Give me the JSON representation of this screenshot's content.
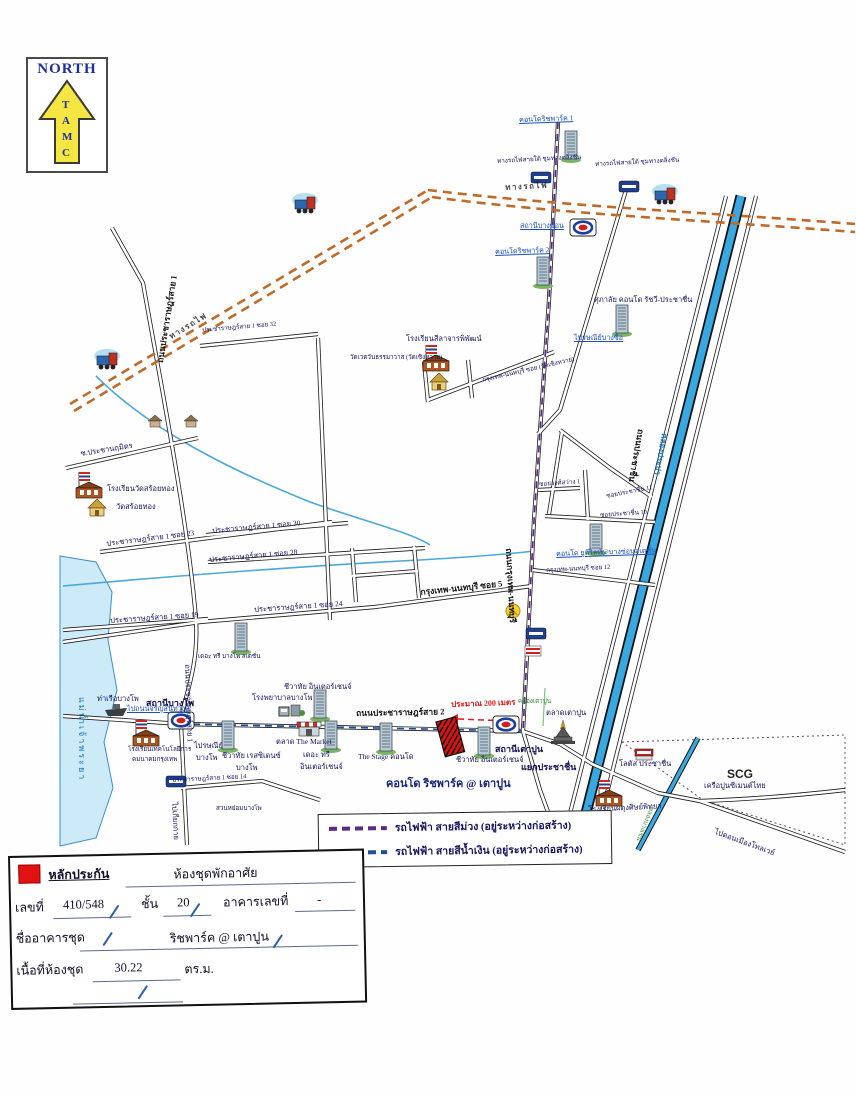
{
  "north": {
    "title": "NORTH",
    "letters": [
      "T",
      "A",
      "M",
      "C"
    ]
  },
  "legend": {
    "items": [
      {
        "label": "รถไฟฟ้า สายสีม่วง (อยู่ระหว่างก่อสร้าง)",
        "color": "#5b2a86"
      },
      {
        "label": "รถไฟฟ้า สายสีน้ำเงิน (อยู่ระหว่างก่อสร้าง)",
        "color": "#1c4f9c"
      }
    ]
  },
  "form": {
    "guarantee_label": "หลักประกัน",
    "type_value": "ห้องชุดพักอาศัย",
    "no_label": "เลขที่",
    "no_value": "410/548",
    "floor_label": "ชั้น",
    "floor_value": "20",
    "building_no_label": "อาคารเลขที่",
    "building_no_value": "-",
    "building_name_label": "ชื่ออาคารชุด",
    "building_name_value": "ริชพาร์ค @ เตาปูน",
    "area_label": "เนื้อที่ห้องชุด",
    "area_value": "30.22",
    "area_unit": "ตร.ม."
  },
  "colors": {
    "mrt_purple": "#5b2a86",
    "mrt_blue": "#1c4f9c",
    "railway": "#c06a28",
    "canal": "#39a7e0",
    "river_fill": "#cdeaf8",
    "subject_red": "#e11212"
  },
  "map": {
    "labels": [
      {
        "name": "condo-richpark1-label",
        "text": "คอนโดริชพาร์ค 1",
        "x": 519,
        "y": 117,
        "cls": "blue",
        "rot": -2
      },
      {
        "name": "railway-caption-1",
        "text": "ทางรถไฟสายใต้ ชุมทางตลิ่งชัน",
        "x": 497,
        "y": 159,
        "cls": "sm6",
        "rot": -3
      },
      {
        "name": "railway-caption-2",
        "text": "ทางรถไฟสายใต้ ชุมทางตลิ่งชัน",
        "x": 595,
        "y": 162,
        "cls": "sm6",
        "rot": -3
      },
      {
        "name": "station-bangson-label",
        "text": "สถานีบางซ่อน",
        "x": 520,
        "y": 223,
        "cls": "blue"
      },
      {
        "name": "condo-richpark2-label",
        "text": "คอนโดริชพาร์ค 2",
        "x": 495,
        "y": 249,
        "cls": "blue",
        "rot": -2
      },
      {
        "name": "condo-supalai-label",
        "text": "ศุภาลัย คอนโด รัชวี-ประชาชื่น",
        "x": 594,
        "y": 296,
        "cls": ""
      },
      {
        "name": "post-bangsue-label",
        "text": "ไปรษณีย์บางซื่อ",
        "x": 574,
        "y": 335,
        "cls": "blue"
      },
      {
        "name": "road-pracharat1-label-top",
        "text": "ถนนประชาราษฎร์สาย 1",
        "x": 156,
        "y": 362,
        "cls": "rd",
        "rot": -81
      },
      {
        "name": "soi32-label",
        "text": "ประชาราษฎร์สาย 1 ซอย 32",
        "x": 202,
        "y": 328,
        "cls": "sm6",
        "rot": -5
      },
      {
        "name": "school-silacharn-label",
        "text": "โรงเรียนสีลาจารพิพัฒน์",
        "x": 406,
        "y": 335,
        "cls": ""
      },
      {
        "name": "wat-soenghwai-label",
        "text": "วัดเวตวันธรรมาวาส (วัดเซิงหวาย)",
        "x": 350,
        "y": 355,
        "cls": "sm6"
      },
      {
        "name": "soi-wat-soenghwai-label",
        "text": "กรุงเทพ-นนทบุรี ซอย (วัดเซิงหวาย)",
        "x": 482,
        "y": 378,
        "cls": "sm6",
        "rot": -13
      },
      {
        "name": "soi-prachanarumit-label",
        "text": "ซ.ประชานฤมิตร",
        "x": 80,
        "y": 450,
        "cls": "",
        "rot": -9
      },
      {
        "name": "school-watsoithong-label",
        "text": "โรงเรียนวัดสร้อยทอง",
        "x": 107,
        "y": 485,
        "cls": ""
      },
      {
        "name": "wat-soithong-label",
        "text": "วัดสร้อยทอง",
        "x": 116,
        "y": 503,
        "cls": ""
      },
      {
        "name": "soi23-label",
        "text": "ประชาราษฎร์สาย 1 ซอย 23",
        "x": 106,
        "y": 540,
        "cls": "",
        "rot": -7
      },
      {
        "name": "soi30-label",
        "text": "ประชาราษฎร์สาย 1 ซอย 30",
        "x": 212,
        "y": 527,
        "cls": "",
        "rot": -5
      },
      {
        "name": "soi28-label",
        "text": "ประชาราษฎร์สาย 1 ซอย 28",
        "x": 209,
        "y": 556,
        "cls": "",
        "rot": -5
      },
      {
        "name": "soi24-label",
        "text": "ประชาราษฎร์สาย 1 ซอย 24",
        "x": 254,
        "y": 606,
        "cls": "",
        "rot": -4
      },
      {
        "name": "soi19-label",
        "text": "ประชาราษฎร์สาย 1 ซอย 19",
        "x": 110,
        "y": 617,
        "cls": "",
        "rot": -4
      },
      {
        "name": "krungthep-non-soi5-label",
        "text": "กรุงเทพ-นนทบุรี ซอย 5",
        "x": 420,
        "y": 588,
        "cls": "rd",
        "rot": -6
      },
      {
        "name": "soi-wongsawang1-label",
        "text": "ซอยวงศ์สว่าง 1",
        "x": 539,
        "y": 482,
        "cls": "sm6",
        "rot": -4
      },
      {
        "name": "soi-prachachuen11-label",
        "text": "ซอยประชาชื่น 11",
        "x": 606,
        "y": 494,
        "cls": "sm6",
        "rot": -11
      },
      {
        "name": "soi-prachachuen10-label",
        "text": "ซอยประชาชื่น 10",
        "x": 600,
        "y": 513,
        "cls": "sm6",
        "rot": -4
      },
      {
        "name": "condo-udelight-label",
        "text": "คอนโด ยูดีไลท์@บางซ่อนสเตชั่น",
        "x": 556,
        "y": 551,
        "cls": "blue",
        "rot": -2
      },
      {
        "name": "krungthep-non-soi12-label",
        "text": "กรุงเทพ-นนทบุรี ซอย 12",
        "x": 546,
        "y": 568,
        "cls": "sm6",
        "rot": -3
      },
      {
        "name": "road-krungthep-non-label",
        "text": "ถนนกรุงเทพ-นนทบุรี",
        "x": 513,
        "y": 548,
        "cls": "rd",
        "rot": 87
      },
      {
        "name": "road-prachachuen-label",
        "text": "ถนนประชาชื่น",
        "x": 645,
        "y": 430,
        "cls": "rd",
        "rot": 100
      },
      {
        "name": "canal-prapa-label",
        "text": "คลองประปา",
        "x": 668,
        "y": 434,
        "cls": "canal",
        "rot": 100
      },
      {
        "name": "talat-taopoon-label",
        "text": "ตลาดเตาปูน",
        "x": 546,
        "y": 709,
        "cls": ""
      },
      {
        "name": "canal-taopoon-label",
        "text": "คลองเตาปูน",
        "x": 518,
        "y": 699,
        "cls": "green"
      },
      {
        "name": "station-taopoon-label",
        "text": "สถานีเตาปูน",
        "x": 495,
        "y": 745,
        "cls": "st"
      },
      {
        "name": "yaek-prachachuen-label",
        "text": "แยกประชาชื่น",
        "x": 521,
        "y": 763,
        "cls": "st"
      },
      {
        "name": "lotus-label",
        "text": "โลตัส ประชาชื่น",
        "x": 619,
        "y": 760,
        "cls": ""
      },
      {
        "name": "scg-label",
        "text": "SCG",
        "x": 727,
        "y": 768,
        "cls": "scg"
      },
      {
        "name": "scg-sub-label",
        "text": "เครือปูนซีเมนต์ไทย",
        "x": 704,
        "y": 782,
        "cls": ""
      },
      {
        "name": "school-phadung-label",
        "text": "โรงเรียนผดุงศิษย์พิทยา",
        "x": 588,
        "y": 806,
        "cls": "",
        "rot": -3
      },
      {
        "name": "to-tollway-label",
        "text": "ไปดอนเมืองโทลเวย์",
        "x": 716,
        "y": 828,
        "cls": "",
        "rot": 20
      },
      {
        "name": "canal-bangkhen-label",
        "text": "คลองบางเขน",
        "x": 654,
        "y": 808,
        "cls": "green",
        "rot": 112
      },
      {
        "name": "distance-label",
        "text": "ประมาณ 200 เมตร",
        "x": 451,
        "y": 701,
        "cls": "red",
        "rot": -2
      },
      {
        "name": "condo-richpark-taopoon-label",
        "text": "คอนโด ริชพาร์ค @ เตาปูน",
        "x": 386,
        "y": 778,
        "cls": "big"
      },
      {
        "name": "chewathai-interchange1-label",
        "text": "ชีวาทัย อินเตอร์เชนจ์",
        "x": 284,
        "y": 683,
        "cls": ""
      },
      {
        "name": "hospital-bangpho-label",
        "text": "โรงพยาบาลบางโพ",
        "x": 252,
        "y": 694,
        "cls": ""
      },
      {
        "name": "road-pracharat2-label",
        "text": "ถนนประชาราษฎร์สาย 2",
        "x": 356,
        "y": 709,
        "cls": "rd",
        "rot": -1
      },
      {
        "name": "chewathai-interchange2-label",
        "text": "ชีวาทัย อินเตอร์เชนจ์",
        "x": 456,
        "y": 756,
        "cls": ""
      },
      {
        "name": "the-stage-label",
        "text": "The Stage คอนโด",
        "x": 358,
        "y": 753,
        "cls": ""
      },
      {
        "name": "the-tree-interchange-label1",
        "text": "เดอะ ทรี",
        "x": 303,
        "y": 751,
        "cls": ""
      },
      {
        "name": "the-tree-interchange-label2",
        "text": "อินเตอร์เชนจ์",
        "x": 300,
        "y": 763,
        "cls": ""
      },
      {
        "name": "the-market-label",
        "text": "ตลาด The Market",
        "x": 276,
        "y": 738,
        "cls": ""
      },
      {
        "name": "chewathai-residence-label1",
        "text": "ชีวาทัย เรสซิเดนซ์",
        "x": 222,
        "y": 752,
        "cls": ""
      },
      {
        "name": "chewathai-residence-label2",
        "text": "บางโพ",
        "x": 236,
        "y": 764,
        "cls": ""
      },
      {
        "name": "post-bangpho-label1",
        "text": "ไปรษณีย์",
        "x": 194,
        "y": 742,
        "cls": ""
      },
      {
        "name": "post-bangpho-label2",
        "text": "บางโพ",
        "x": 196,
        "y": 754,
        "cls": ""
      },
      {
        "name": "the-tree-bangpho-label",
        "text": "เดอะ ทรี บางโพ สเตชั่น",
        "x": 198,
        "y": 654,
        "cls": "sm6"
      },
      {
        "name": "station-bangpho-label",
        "text": "สถานีบางโพ",
        "x": 146,
        "y": 699,
        "cls": "st"
      },
      {
        "name": "pier-bangpho-label",
        "text": "ท่าเรือบางโพ",
        "x": 97,
        "y": 695,
        "cls": ""
      },
      {
        "name": "to-charan-label",
        "text": "ไปถนนจรัญสนิทวงศ์",
        "x": 127,
        "y": 706,
        "cls": "blue"
      },
      {
        "name": "river-label",
        "text": "แม่น้ำเจ้าพระยา",
        "x": 86,
        "y": 697,
        "cls": "river",
        "rot": 90
      },
      {
        "name": "school-tech-label1",
        "text": "โรงเรียนเทคโนโลยีการ",
        "x": 128,
        "y": 747,
        "cls": "sm6"
      },
      {
        "name": "school-tech-label2",
        "text": "คมนาคมกรุงเทพ",
        "x": 132,
        "y": 757,
        "cls": "sm6"
      },
      {
        "name": "soi14-label",
        "text": "ประชาราษฎร์สาย 1 ซอย 14",
        "x": 172,
        "y": 778,
        "cls": "sm6",
        "rot": -3
      },
      {
        "name": "park-label",
        "text": "สวนหย่อมบางโพ",
        "x": 216,
        "y": 806,
        "cls": "sm6"
      },
      {
        "name": "to-kiakkai-label",
        "text": "ไปเกียกกาย",
        "x": 178,
        "y": 802,
        "cls": "",
        "rot": 87
      },
      {
        "name": "road-pracharat1-label-bottom",
        "text": "ถนนประชาราษฎร์สาย 1",
        "x": 191,
        "y": 664,
        "cls": "",
        "rot": 88
      },
      {
        "name": "rail-text-1",
        "text": "ทางรถไฟ",
        "x": 168,
        "y": 334,
        "cls": "rail",
        "rot": -31
      },
      {
        "name": "rail-text-2",
        "text": "ทางรถไฟ",
        "x": 505,
        "y": 184,
        "cls": "rail",
        "rot": -3
      }
    ],
    "icons": [
      {
        "name": "condo-richpark1-icon",
        "type": "condo",
        "x": 564,
        "y": 131
      },
      {
        "name": "condo-richpark2-icon",
        "type": "condo",
        "x": 536,
        "y": 257
      },
      {
        "name": "condo-supalai-icon",
        "type": "condo",
        "x": 615,
        "y": 305
      },
      {
        "name": "condo-udelight-icon",
        "type": "condo",
        "x": 589,
        "y": 524
      },
      {
        "name": "condo-tree-bangpho-icon",
        "type": "condo",
        "x": 234,
        "y": 623
      },
      {
        "name": "condo-chewathai1-icon",
        "type": "condo",
        "x": 313,
        "y": 690
      },
      {
        "name": "condo-chewathai-residence-icon",
        "type": "condo",
        "x": 221,
        "y": 721
      },
      {
        "name": "condo-tree-interchange-icon",
        "type": "condo",
        "x": 324,
        "y": 721
      },
      {
        "name": "condo-stage-icon",
        "type": "condo",
        "x": 379,
        "y": 723
      },
      {
        "name": "condo-chewathai2-icon",
        "type": "condo",
        "x": 477,
        "y": 727
      },
      {
        "name": "school-silacharn-icon",
        "type": "school",
        "x": 423,
        "y": 345
      },
      {
        "name": "school-watsoithong-icon",
        "type": "school",
        "x": 76,
        "y": 472
      },
      {
        "name": "school-tech-icon",
        "type": "school",
        "x": 133,
        "y": 720
      },
      {
        "name": "school-phadung-icon",
        "type": "school",
        "x": 596,
        "y": 780
      },
      {
        "name": "wat-soithong-icon",
        "type": "temple",
        "x": 86,
        "y": 498
      },
      {
        "name": "wat-soenghwai-icon",
        "type": "temple",
        "x": 428,
        "y": 372
      },
      {
        "name": "taopoon-pagoda-icon",
        "type": "pagoda",
        "x": 551,
        "y": 720
      },
      {
        "name": "the-market-icon",
        "type": "market",
        "x": 297,
        "y": 722
      },
      {
        "name": "lotus-store-icon",
        "type": "store",
        "x": 635,
        "y": 749
      },
      {
        "name": "hospital-bangpho-icon",
        "type": "hospital",
        "x": 279,
        "y": 702
      },
      {
        "name": "bangpho-pier-boat-icon",
        "type": "boat",
        "x": 105,
        "y": 704
      },
      {
        "name": "train-icon-1",
        "type": "train",
        "x": 93,
        "y": 348
      },
      {
        "name": "train-icon-2",
        "type": "train",
        "x": 291,
        "y": 192
      },
      {
        "name": "train-icon-3",
        "type": "train",
        "x": 651,
        "y": 183
      },
      {
        "name": "mrt-bangson-icon",
        "type": "mrt",
        "x": 570,
        "y": 219
      },
      {
        "name": "mrt-bangpho-icon",
        "type": "mrt",
        "x": 168,
        "y": 712
      },
      {
        "name": "mrt-taopoon-icon",
        "type": "mrt",
        "x": 493,
        "y": 716
      },
      {
        "name": "sign-blue-icon-1",
        "type": "sign-blue",
        "x": 531,
        "y": 172
      },
      {
        "name": "sign-blue-icon-2",
        "type": "sign-blue",
        "x": 619,
        "y": 181
      },
      {
        "name": "sign-blue-icon-3",
        "type": "sign-blue",
        "x": 526,
        "y": 628
      },
      {
        "name": "sign-blue-icon-4",
        "type": "sign-blue",
        "x": 166,
        "y": 776
      },
      {
        "name": "sign-red-icon",
        "type": "sign-red",
        "x": 525,
        "y": 646
      },
      {
        "name": "poi-yellow-icon",
        "type": "dot-yellow",
        "x": 506,
        "y": 604
      },
      {
        "name": "pavilion-icon-1",
        "type": "pav",
        "x": 147,
        "y": 414
      },
      {
        "name": "pavilion-icon-2",
        "type": "pav",
        "x": 183,
        "y": 414
      },
      {
        "name": "subject-property-icon",
        "type": "subject",
        "x": 436,
        "y": 722,
        "rot": -15
      }
    ]
  }
}
